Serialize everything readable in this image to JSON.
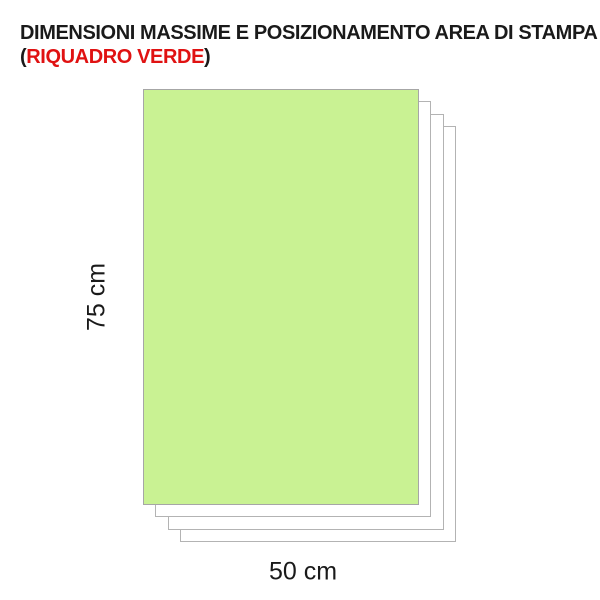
{
  "title": {
    "line1": "DIMENSIONI MASSIME E POSIZIONAMENTO AREA DI STAMPA",
    "line2_prefix": "(",
    "line2_highlight": "RIQUADRO VERDE",
    "line2_suffix": ")"
  },
  "diagram": {
    "print_area": {
      "height_label": "75 cm",
      "width_label": "50 cm",
      "fill_color": "#c9f293",
      "border_color": "#a6a6a6"
    },
    "sheets": {
      "count": 3,
      "fill_color": "#ffffff",
      "border_color": "#b3b3b3"
    }
  },
  "colors": {
    "title_text": "#1a1a1a",
    "highlight_red": "#e01212",
    "background": "#ffffff"
  }
}
